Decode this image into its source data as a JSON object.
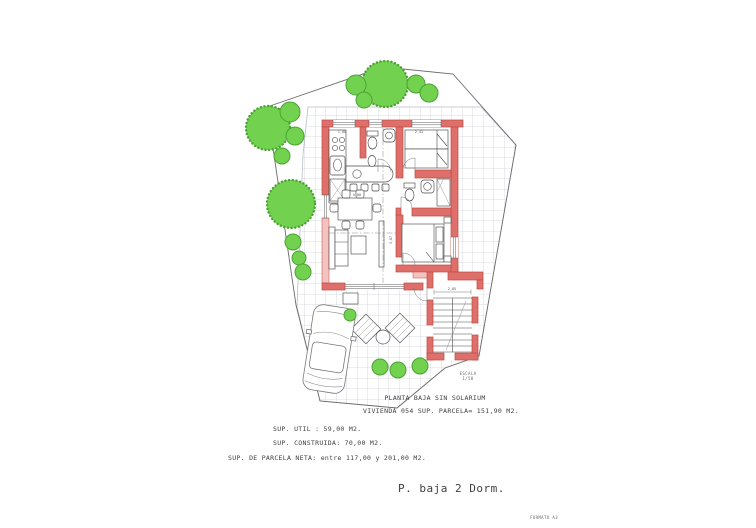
{
  "title_block": {
    "line1": "PLANTA BAJA SIN SOLARIUM",
    "line2": "VIVIENDA 054 SUP. PARCELA= 151,90 M2."
  },
  "surface_info": {
    "util": "SUP. UTIL : 59,00 M2.",
    "construida": "SUP. CONSTRUIDA: 70,00 M2.",
    "parcela_neta": "SUP. DE PARCELA NETA: entre 117,00 y 201,00 M2."
  },
  "footer": {
    "plan_type": "P. baja 2 Dorm.",
    "format_note": "FORMATO A3"
  },
  "drawing": {
    "scale_label": "ESCALA",
    "scale_value": "1/50",
    "dimension_labels": {
      "kitchen_width": "1,80",
      "bedroom2_width": "2,41",
      "stair_width": "2,85",
      "living_width": "5,00",
      "living_depth": "3,87"
    }
  },
  "colors": {
    "wall": "#df6f6a",
    "wall_light": "#f3c3c0",
    "wall_stroke": "#bf4a45",
    "tree_fill": "#72d24f",
    "tree_stroke": "#4aa233",
    "tile_line": "#b6bdc9",
    "boundary_line": "#6b6b6b",
    "drawing_line": "#4a4a4a",
    "text": "#3f3f3f"
  }
}
